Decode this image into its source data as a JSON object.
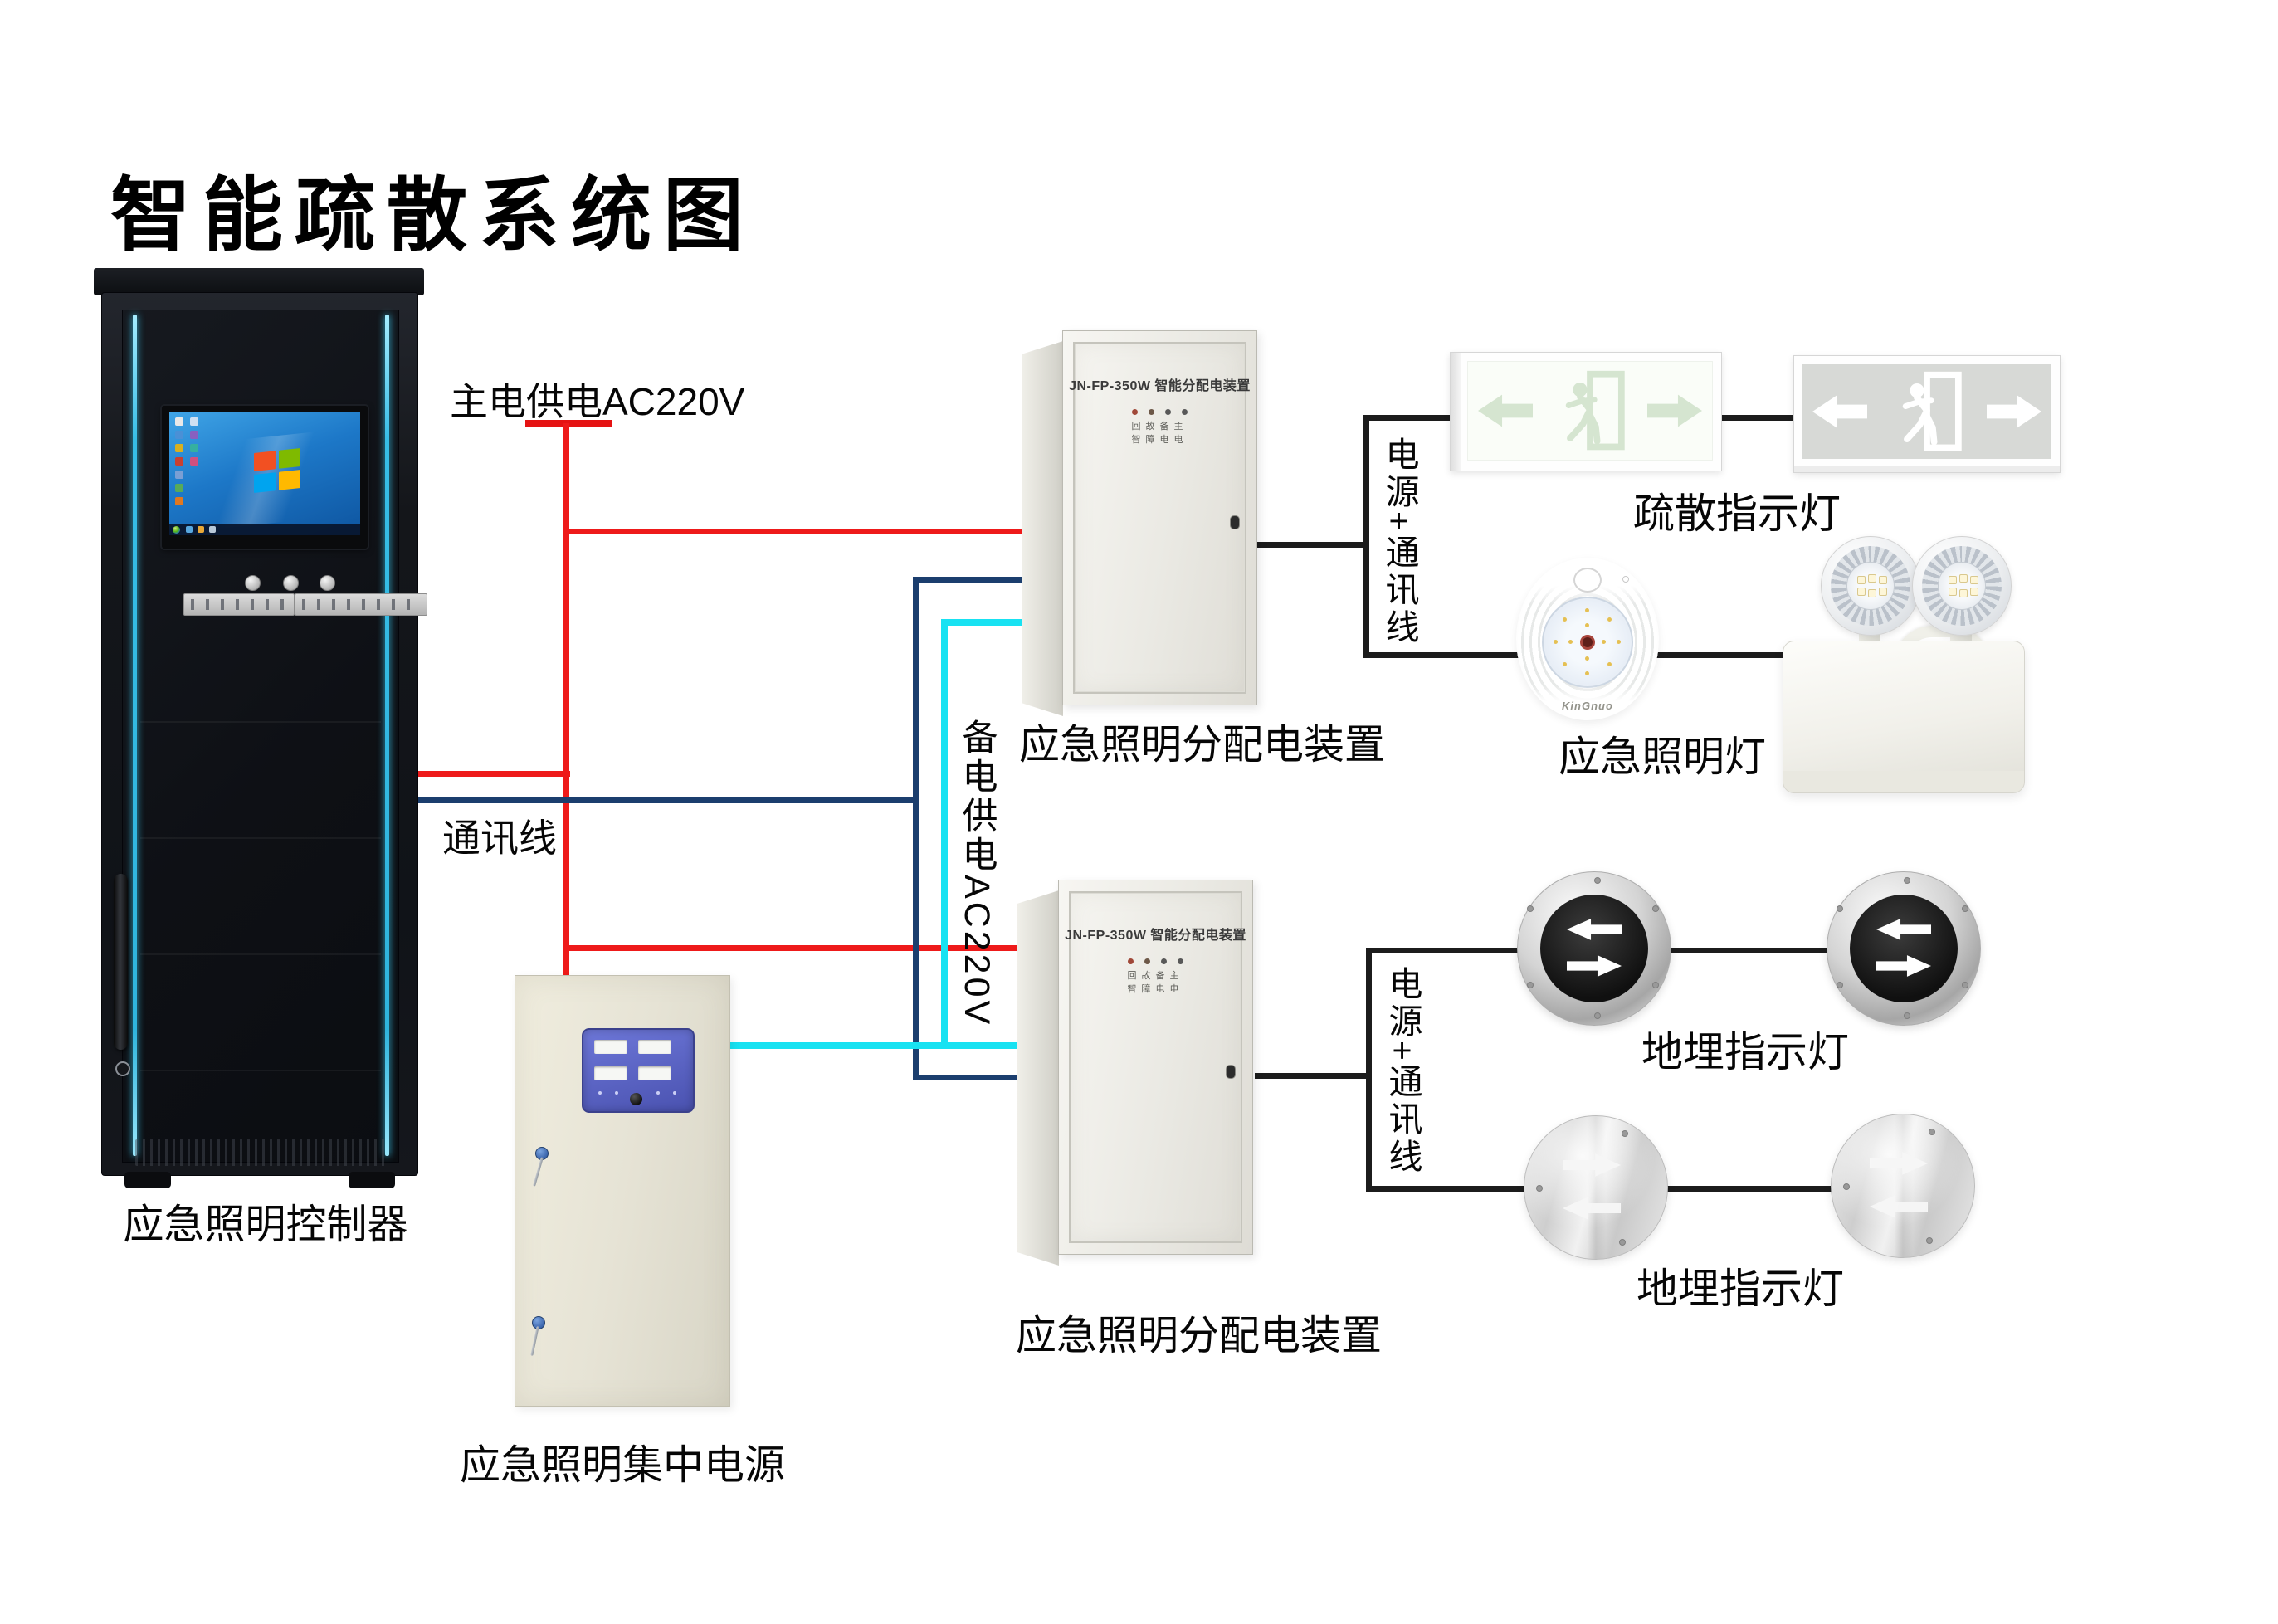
{
  "page": {
    "title": "智能疏散系统图"
  },
  "wires": {
    "main_power_label": "主电供电AC220V",
    "comm_label": "通讯线",
    "backup_power_label": "备电供电AC220V",
    "colors": {
      "main": "#ee1a1a",
      "comm": "#1b3e6e",
      "backup": "#18e2f2",
      "signal": "#1c1c1c"
    }
  },
  "junctions": {
    "j1_label": "电源+通讯线",
    "j2_label": "电源+通讯线"
  },
  "controller": {
    "label": "应急照明控制器"
  },
  "central_power": {
    "label": "应急照明集中电源"
  },
  "distribution1": {
    "model": "JN-FP-350W 智能分配电装置",
    "leds_row1": "回故备主",
    "leds_row2": "智障电电",
    "label": "应急照明分配电装置"
  },
  "distribution2": {
    "model": "JN-FP-350W 智能分配电装置",
    "leds_row1": "回故备主",
    "leds_row2": "智障电电",
    "label": "应急照明分配电装置"
  },
  "evac_signs": {
    "label": "疏散指示灯"
  },
  "emergency_lamps": {
    "label": "应急照明灯",
    "brand": "KinGnuo"
  },
  "ground_lights_row1": {
    "label": "地埋指示灯"
  },
  "ground_lights_row2": {
    "label": "地埋指示灯"
  }
}
